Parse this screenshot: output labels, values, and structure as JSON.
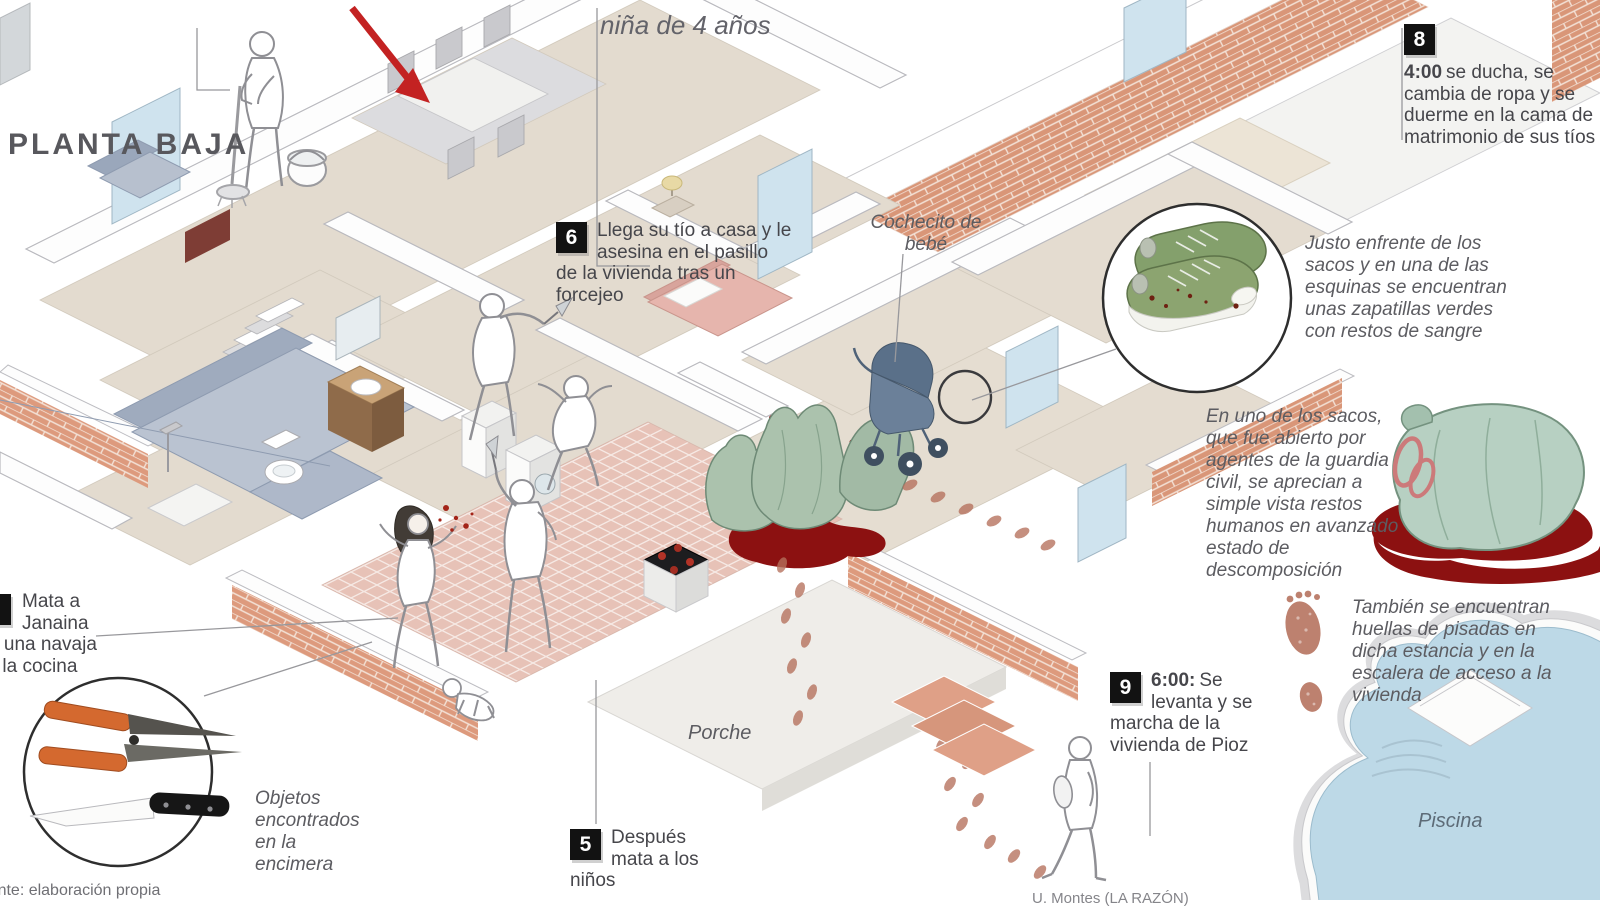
{
  "header": {
    "floor_label": "PLANTA BAJA"
  },
  "labels": {
    "girl": "niña de 4 años",
    "stroller": "Cochecito de bebé",
    "porch": "Porche",
    "pool": "Piscina"
  },
  "callouts": {
    "c5": {
      "num": "5",
      "text": "Después mata a los niños"
    },
    "c6": {
      "num": "6",
      "text": "Llega su tío a casa y le asesina en el pasillo de la vivienda tras un forcejeo"
    },
    "c8": {
      "num": "8",
      "time": "4:00",
      "text": "se ducha, se cambia de ropa y se duerme en la cama de matrimonio de sus tíos"
    },
    "c9": {
      "num": "9",
      "time": "6:00:",
      "text": "Se levanta y se marcha de la vivienda de Pioz"
    },
    "janaina": {
      "lines": [
        "Mata a",
        "Janaina",
        "con una navaja",
        "en la cocina"
      ]
    }
  },
  "notes": {
    "shoes": "Justo enfrente de los sacos y en una de las esquinas se encuentran unas zapatillas verdes con restos de sangre",
    "sacks": "En uno de los sacos, que fue abierto por agentes de la guardia civil, se aprecian a simple vista restos humanos en avanzado estado de descomposición",
    "footprints": "También se encuentran huellas de pisadas en dicha estancia y en la escalera de acceso a la vivienda",
    "objects": "Objetos encontrados en la encimera"
  },
  "credits": {
    "source": "Fuente: elaboración propia",
    "author": "U. Montes (LA RAZÓN)"
  },
  "colors": {
    "brick": "#dd9a7d",
    "blood": "#8c1111",
    "water": "#bdd9e7",
    "bag_green": "#b7d0c2",
    "accent_red": "#c32222",
    "footprint": "#b5705c"
  }
}
